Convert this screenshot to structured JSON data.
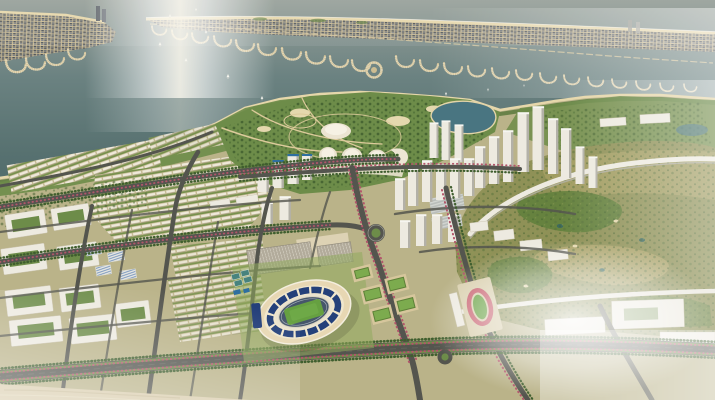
{
  "scene": {
    "label": "Aerial 3D architectural rendering of a coastal city master plan",
    "type": "3d-aerial-masterplan-rendering",
    "landmarks": [
      "sea-with-sun-glint",
      "barrier-island",
      "beach-strip",
      "marina-piers",
      "round-marina-island",
      "sailboats",
      "lagoon",
      "waterfront-park-peninsula",
      "dome-pavilions",
      "city-lake",
      "highrise-tower-cluster",
      "midrise-district",
      "rowhouse-district",
      "courtyard-blocks",
      "campus-glass-buildings",
      "stadium",
      "running-track-oval",
      "sports-fields",
      "tennis-courts",
      "parking-lots",
      "golf-course",
      "golf-edge-buildings",
      "white-complexes",
      "boulevard",
      "avenues",
      "roundabout",
      "flowering-street-trees",
      "sandy-foreshore",
      "atmospheric-haze"
    ]
  },
  "palette": {
    "sea_top": "#97a099",
    "sea_mid": "#5e7877",
    "sea_deep": "#4c6667",
    "glint": "#f9f6ec",
    "sand": "#cfbf95",
    "beach": "#e6d7ab",
    "pier": "#d6c69c",
    "boat": "#f2f1ea",
    "block_dark": "#4e5358",
    "block_mid": "#7c8187",
    "land": "#c6ba92",
    "park_green": "#6d8c49",
    "tree_dark": "#3f5e2e",
    "tree_mid": "#4e6f36",
    "lawn": "#8fa95c",
    "golf_base": "#8f9157",
    "fairway": "#5f7f3b",
    "rough": "#b2a76b",
    "bunker": "#e4d8ae",
    "pond": "#3e6a5e",
    "lake": "#497581",
    "road": "#54554e",
    "road_light": "#8b8c84",
    "building_white": "#edeae0",
    "building_shade": "#b3b1a8",
    "building_tan": "#ddd2b4",
    "glass_blue": "#6f8fba",
    "pool_teal": "#2e6fa0",
    "court_teal": "#47837e",
    "stadium_navy": "#24407a",
    "stadium_cream": "#e7d7b3",
    "track_slate": "#46566b",
    "pitch": "#66a041",
    "blossom": "#b2566b",
    "sand_fore": "#d8cbaa",
    "haze": "#ffffff"
  }
}
